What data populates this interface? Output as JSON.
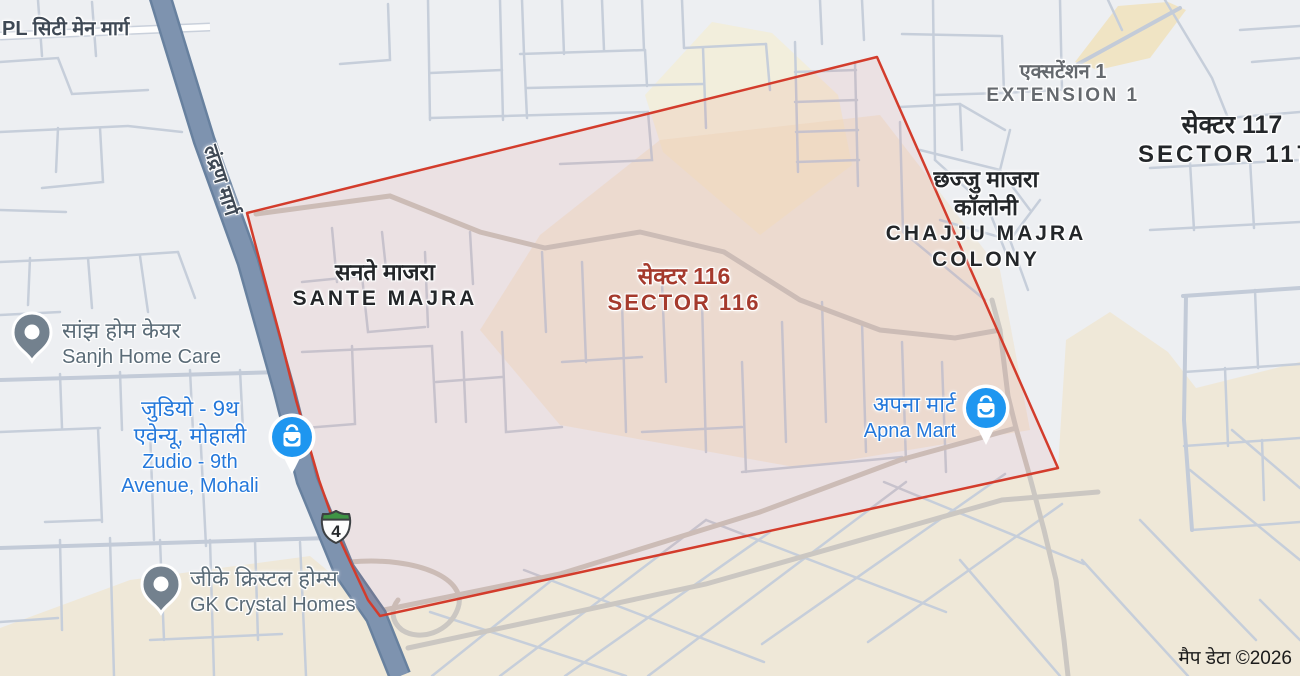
{
  "map": {
    "attribution": "मैप डेटा ©2026",
    "route_shield": {
      "number": "4"
    },
    "road_labels": [
      {
        "id": "pl-city-main-marg",
        "text": "PL सिटी मेन मार्ग"
      },
      {
        "id": "landran-marg",
        "text": "लंद्रण मार्ग"
      }
    ],
    "localities": [
      {
        "id": "sante-majra",
        "hi": "सनते माजरा",
        "en": "SANTE MAJRA"
      },
      {
        "id": "sector-116",
        "hi": "सेक्टर 116",
        "en": "SECTOR 116",
        "highlighted": true
      },
      {
        "id": "extension-1",
        "hi": "एक्सटेंशन 1",
        "en": "EXTENSION 1"
      },
      {
        "id": "sector-117",
        "hi": "सेक्टर 117",
        "en": "SECTOR 117"
      },
      {
        "id": "chajju-majra-colony",
        "hi_line1": "छज्जु माजरा",
        "hi_line2": "कॉलोनी",
        "en_line1": "CHAJJU MAJRA",
        "en_line2": "COLONY"
      }
    ],
    "pois": [
      {
        "id": "sanjh-home-care",
        "hi": "सांझ होम केयर",
        "en": "Sanjh Home Care",
        "type": "generic"
      },
      {
        "id": "zudio",
        "hi_line1": "जुडियो - 9थ",
        "hi_line2": "एवेन्यू, मोहाली",
        "en_line1": "Zudio - 9th",
        "en_line2": "Avenue, Mohali",
        "type": "shopping"
      },
      {
        "id": "gk-crystal-homes",
        "hi": "जीके क्रिस्टल होम्स",
        "en": "GK Crystal Homes",
        "type": "generic"
      },
      {
        "id": "apna-mart",
        "hi": "अपना मार्ट",
        "en": "Apna Mart",
        "type": "shopping"
      }
    ],
    "colors": {
      "background": "#EDEFF2",
      "landcover_beige": "#EFE8D8",
      "highway_fill": "#7E93AF",
      "minor_road": "#C6CEDA",
      "boundary_red": "#D33C2C",
      "selected_sector_label": "#A53A2D",
      "poi_blue": "#2478DB",
      "poi_gray": "#5A6B77",
      "locality_text": "#232629",
      "pin_blue": "#1E96F0",
      "pin_gray": "#73818E",
      "shield_green": "#3F9445"
    }
  }
}
